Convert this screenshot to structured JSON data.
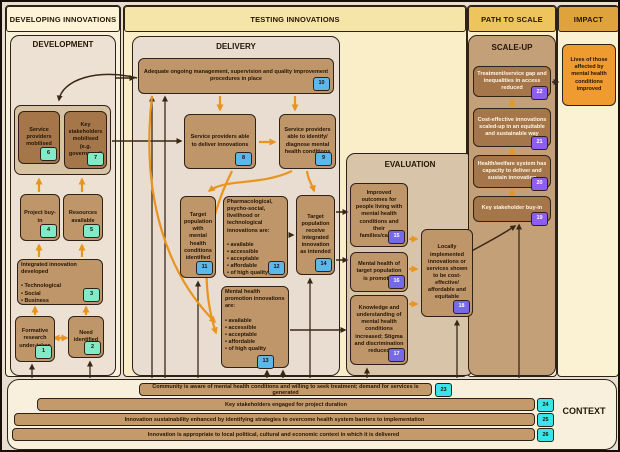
{
  "headers": {
    "developing": "DEVELOPING INNOVATIONS",
    "testing": "TESTING INNOVATIONS",
    "path_to_scale": "PATH TO SCALE",
    "impact": "IMPACT"
  },
  "palette": {
    "badge_development": "#82eac6",
    "badge_delivery": "#5cb8ea",
    "badge_evaluation": "#7668ea",
    "badge_scaleup": "#8e5df2",
    "badge_context": "#3ae4ea",
    "arrow_orange": "#e8941e",
    "arrow_dark": "#3a2817",
    "impact_box": "#ef9b30"
  },
  "development": {
    "title": "DEVELOPMENT",
    "boxes": {
      "b1": {
        "text": "Formative research under-taken",
        "badge": "1"
      },
      "b2": {
        "text": "Need identified",
        "badge": "2"
      },
      "b3": {
        "text": "Integrated innovation developed\n\n• Technological\n• Social\n• Business",
        "badge": "3"
      },
      "b4": {
        "text": "Project buy-in",
        "badge": "4"
      },
      "b5": {
        "text": "Resources available",
        "badge": "5"
      },
      "b6": {
        "text": "Service providers mobilised",
        "badge": "6"
      },
      "b7": {
        "text": "Key stakeholders mobilised (e.g. government)",
        "badge": "7"
      }
    }
  },
  "delivery": {
    "title": "DELIVERY",
    "boxes": {
      "b8": {
        "text": "Service providers able to deliver innovations",
        "badge": "8"
      },
      "b9": {
        "text": "Service providers able to identify/ diagnose mental health conditions",
        "badge": "9"
      },
      "b10": {
        "text": "Adequate ongoing management, supervision and quality improvement procedures in place",
        "badge": "10"
      },
      "b11": {
        "text": "Target population with mental health conditions identified",
        "badge": "11"
      },
      "b12": {
        "text": "Pharmacological, psycho-social, livelihood or technological innovations are:\n\n• available\n• accessible\n• acceptable\n• affordable\n• of high quality",
        "badge": "12"
      },
      "b13": {
        "text": "Mental health promotion innovations are:\n\n• available\n• accessible\n• acceptable\n• affordable\n• of high quality",
        "badge": "13"
      },
      "b14": {
        "text": "Target population receive integrated innovation as intended",
        "badge": "14"
      }
    }
  },
  "evaluation": {
    "title": "EVALUATION",
    "boxes": {
      "b15": {
        "text": "Improved outcomes for people living with mental health conditions and their families/carers",
        "badge": "15"
      },
      "b16": {
        "text": "Mental health of target population is promoted",
        "badge": "16"
      },
      "b17": {
        "text": "Knowledge and understanding of mental health conditions increased; Stigma and discrimination reduced",
        "badge": "17"
      },
      "b18": {
        "text": "Locally implemented innovations or services shown to be cost-effective/ affordable and equitable",
        "badge": "18"
      }
    }
  },
  "scale_up": {
    "title": "SCALE-UP",
    "boxes": {
      "b19": {
        "text": "Key stakeholder buy-in",
        "badge": "19"
      },
      "b20": {
        "text": "Health/welfare system has capacity to deliver and sustain innovation",
        "badge": "20"
      },
      "b21": {
        "text": "Cost-effective innovations scaled-up in an equitable and sustainable way",
        "badge": "21"
      },
      "b22": {
        "text": "Treatment/service gap and inequalities in access reduced",
        "badge": "22"
      }
    }
  },
  "impact": {
    "text": "Lives of those affected by mental health conditions improved"
  },
  "context": {
    "title": "CONTEXT",
    "bars": {
      "b23": {
        "text": "Community is aware of mental health conditions and willing to seek treatment; demand for services is generated",
        "badge": "23"
      },
      "b24": {
        "text": "Key stakeholders engaged for project duration",
        "badge": "24"
      },
      "b25": {
        "text": "Innovation sustainability enhanced by identifying strategies to overcome health system barriers to implementation",
        "badge": "25"
      },
      "b26": {
        "text": "Innovation is appropriate to local political, cultural and economic context in which it is delivered",
        "badge": "26"
      }
    }
  }
}
